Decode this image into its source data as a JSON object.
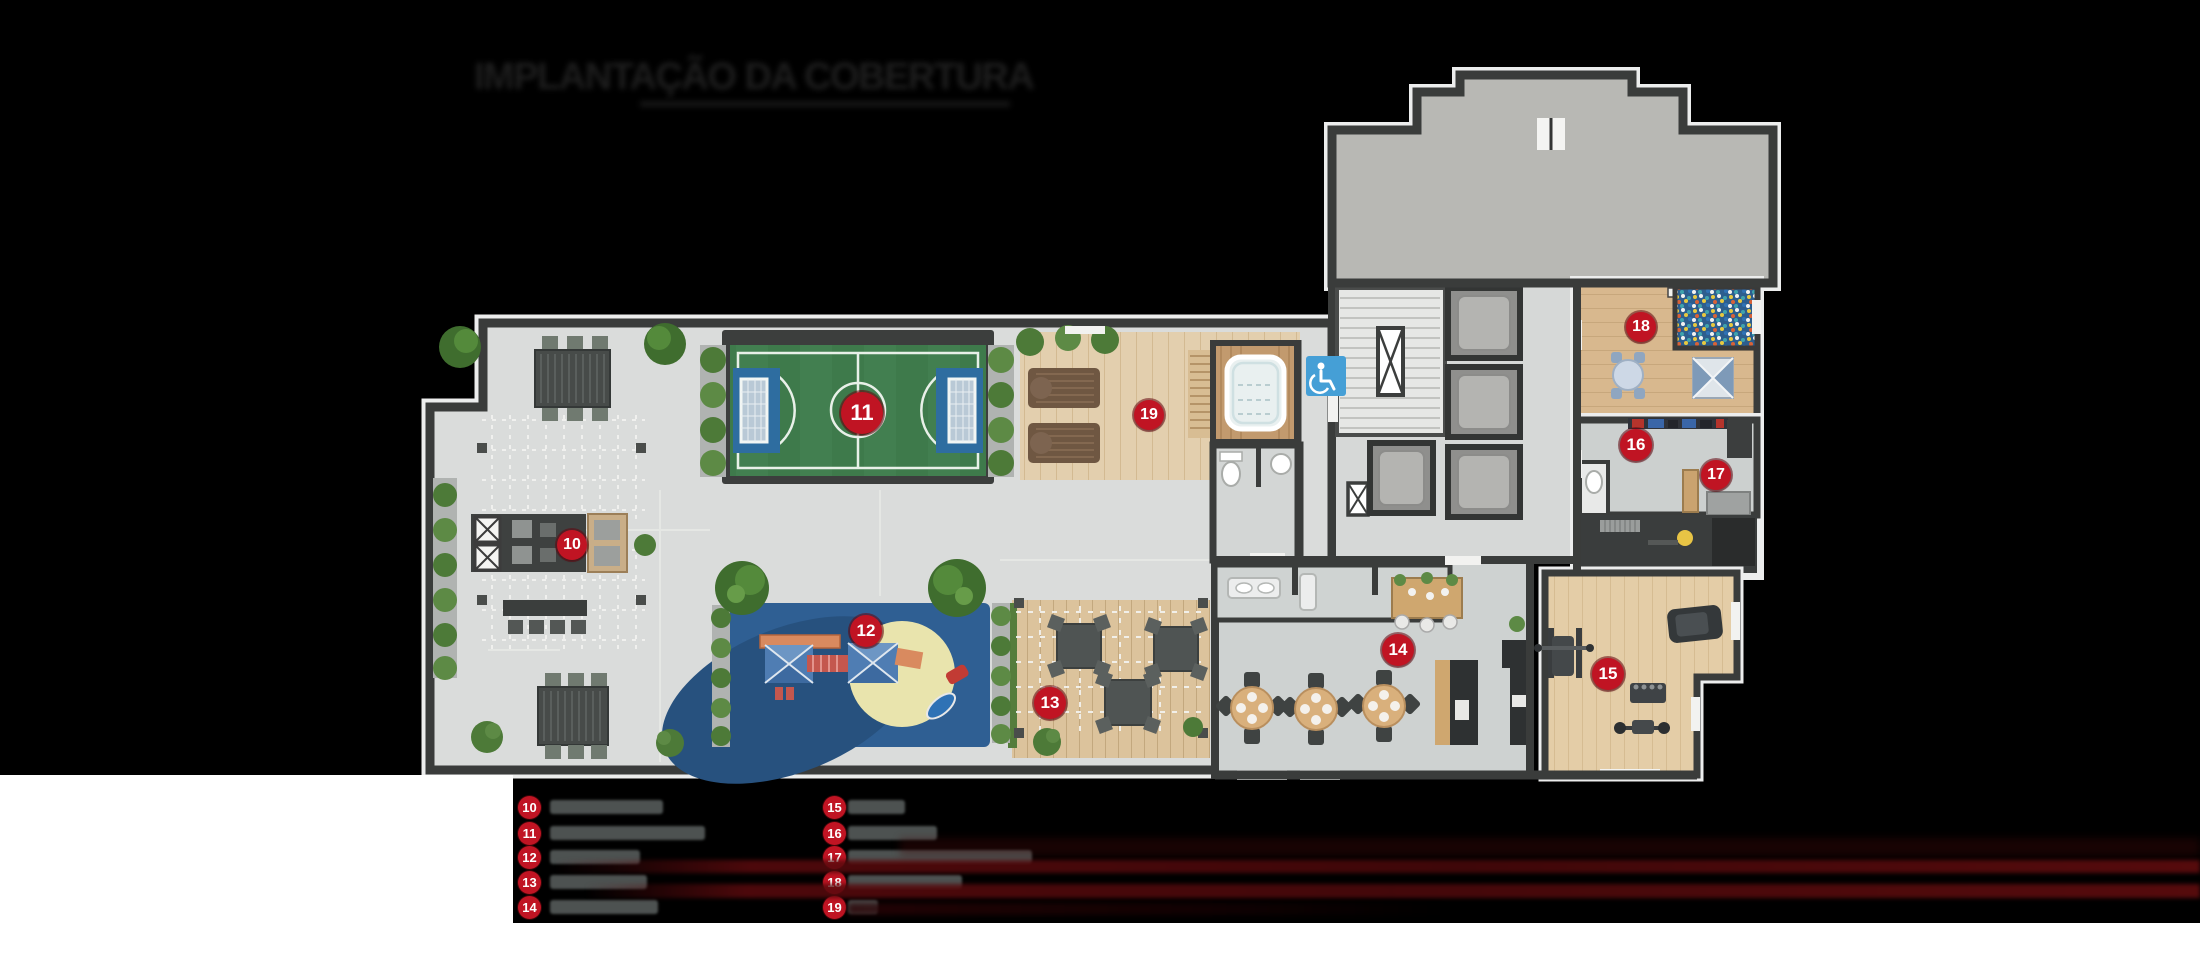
{
  "title": {
    "text": "IMPLANTAÇÃO DA COBERTURA",
    "illegible": true
  },
  "plan_badges": [
    {
      "number": "10"
    },
    {
      "number": "11"
    },
    {
      "number": "12"
    },
    {
      "number": "13"
    },
    {
      "number": "14"
    },
    {
      "number": "15"
    },
    {
      "number": "16"
    },
    {
      "number": "17"
    },
    {
      "number": "18"
    },
    {
      "number": "19"
    }
  ],
  "legend": {
    "columns": [
      {
        "items": [
          {
            "number": "10",
            "label_redacted": true,
            "bar_width_px": 113
          },
          {
            "number": "11",
            "label_redacted": true,
            "bar_width_px": 155
          },
          {
            "number": "12",
            "label_redacted": true,
            "bar_width_px": 90
          },
          {
            "number": "13",
            "label_redacted": true,
            "bar_width_px": 97
          },
          {
            "number": "14",
            "label_redacted": true,
            "bar_width_px": 108
          }
        ]
      },
      {
        "items": [
          {
            "number": "15",
            "label_redacted": true,
            "bar_width_px": 57
          },
          {
            "number": "16",
            "label_redacted": true,
            "bar_width_px": 89
          },
          {
            "number": "17",
            "label_redacted": true,
            "bar_width_px": 184
          },
          {
            "number": "18",
            "label_redacted": true,
            "bar_width_px": 114
          },
          {
            "number": "19",
            "label_redacted": true,
            "bar_width_px": 30
          }
        ]
      }
    ]
  },
  "icons": {
    "accessibility": "wheelchair-icon"
  },
  "colors": {
    "background": "#000000",
    "badge_red": "#c01423",
    "field_green": "#3e7a4b",
    "goal_blue": "#2e6da0",
    "playground_blue": "#2f5f93",
    "sand_yellow": "#e9e4ad",
    "deck_wood": "#e3cfae",
    "hall_gray": "#b8b8b4",
    "floor_gray": "#dadcdb",
    "wall_dark": "#3a3c3b",
    "legend_bar_gray": "#4d5251",
    "streak_red": "#5a0b0e",
    "accessible_blue": "#459fd6"
  }
}
